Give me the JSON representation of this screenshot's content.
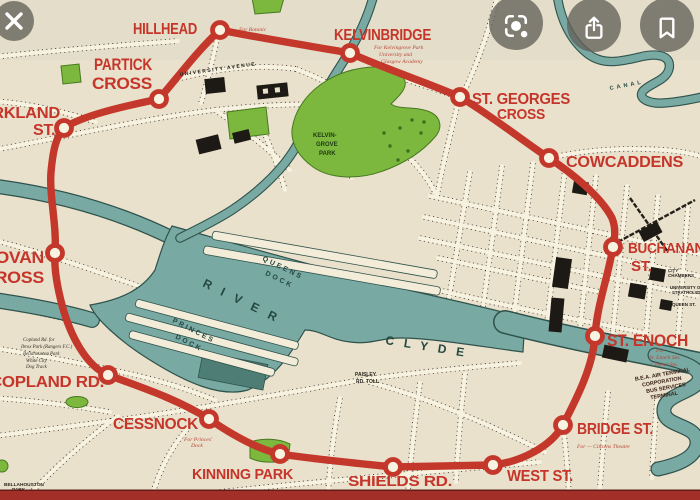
{
  "viewer": {
    "close_icon": "close-x",
    "lens_icon": "camera-lens-search",
    "share_icon": "share-up-arrow",
    "bookmark_icon": "bookmark-outline"
  },
  "map": {
    "stations": [
      {
        "id": "hillhead",
        "name": "HILLHEAD",
        "lines": [
          "HILLHEAD"
        ],
        "notes": [
          "For Botanic",
          "Gardens"
        ]
      },
      {
        "id": "kelvinbridge",
        "name": "KELVINBRIDGE",
        "lines": [
          "KELVINBRIDGE"
        ],
        "notes": [
          "For Kelvingrove Park",
          "University and",
          "Glasgow Academy"
        ]
      },
      {
        "id": "st-georges-cross",
        "name": "ST. GEORGES CROSS",
        "lines": [
          "ST. GEORGES",
          "CROSS"
        ]
      },
      {
        "id": "cowcaddens",
        "name": "COWCADDENS",
        "lines": [
          "COWCADDENS"
        ]
      },
      {
        "id": "buchanan-st",
        "name": "BUCHANAN ST.",
        "lines": [
          "BUCHANAN",
          "ST."
        ]
      },
      {
        "id": "st-enoch",
        "name": "ST. ENOCH",
        "lines": [
          "ST. ENOCH"
        ],
        "notes": [
          "For",
          "St. Enoch Stn.",
          "Central Stn."
        ],
        "notes_bold": [
          "B.E.A. AIR TERMINAL",
          "CORPORATION",
          "BUS SERVICES",
          "TERMINAL"
        ]
      },
      {
        "id": "bridge-st",
        "name": "BRIDGE ST.",
        "lines": [
          "BRIDGE ST."
        ],
        "notes": [
          "For — Citizens Theatre"
        ]
      },
      {
        "id": "west-st",
        "name": "WEST ST.",
        "lines": [
          "WEST ST."
        ]
      },
      {
        "id": "shields-rd",
        "name": "SHIELDS RD.",
        "lines": [
          "SHIELDS RD."
        ]
      },
      {
        "id": "kinning-park",
        "name": "KINNING PARK",
        "lines": [
          "KINNING PARK"
        ]
      },
      {
        "id": "cessnock",
        "name": "CESSNOCK",
        "lines": [
          "CESSNOCK"
        ],
        "notes": [
          "For Princes'",
          "Dock"
        ]
      },
      {
        "id": "copland-rd",
        "name": "COPLAND RD.",
        "lines": [
          "COPLAND RD."
        ],
        "notes": [
          "Copland Rd. for",
          "Ibrox Park (Rangers F.C.)",
          "Bellahouston Park",
          "White City",
          "Dog Track"
        ]
      },
      {
        "id": "govan-cross",
        "name": "GOVAN CROSS",
        "lines": [
          "GOVAN",
          "CROSS"
        ]
      },
      {
        "id": "merkland-st",
        "name": "MERKLAND ST.",
        "lines": [
          "MERKLAND",
          "ST."
        ]
      },
      {
        "id": "partick-cross",
        "name": "PARTICK CROSS",
        "lines": [
          "PARTICK",
          "CROSS"
        ]
      }
    ],
    "region_labels": {
      "river_word1": "RIVER",
      "river_word2": "CLYDE",
      "queens_dock_1": "QUEENS",
      "queens_dock_2": "DOCK",
      "princes_dock_1": "PRINCES",
      "princes_dock_2": "DOCK",
      "kelvingrove_1": "KELVIN-",
      "kelvingrove_2": "GROVE",
      "kelvingrove_3": "PARK",
      "canal": "CANAL",
      "university_avenue": "UNIVERSITY AVENUE",
      "paisley_1": "PAISLEY",
      "paisley_2": "RD. TOLL",
      "bellahouston_1": "BELLAHOUSTON",
      "bellahouston_2": "PARK",
      "city_chambers_1": "CITY",
      "city_chambers_2": "CHAMBERS",
      "queen_st": "QUEEN ST.",
      "strathclyde_1": "UNIVERSITY OF",
      "strathclyde_2": "STRATHCLYDE"
    },
    "colors": {
      "paper": "#e9e1cc",
      "subway_red": "#c4372b",
      "label_red": "#c6352a",
      "water": "#78a9a2",
      "park": "#7cb83e",
      "building": "#1d1914",
      "bottom_bar": "#a23029"
    }
  }
}
